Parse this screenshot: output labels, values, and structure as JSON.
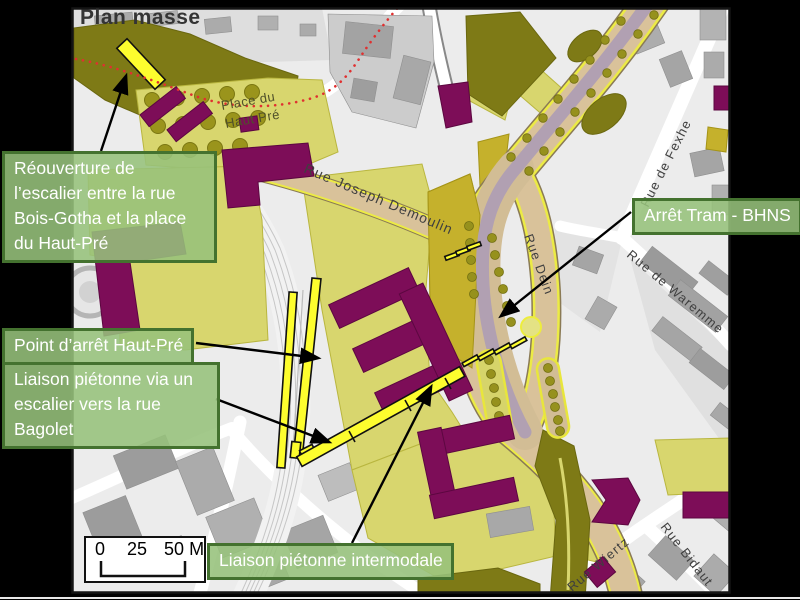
{
  "title": "Plan masse",
  "annotations": {
    "reouverture": "Réouverture de l’escalier entre la rue Bois-Gotha et la place du Haut-Pré",
    "arret_tram": "Arrêt Tram - BHNS",
    "point_arret": "Point d’arrêt Haut-Pré",
    "liaison_escalier": "Liaison piétonne via un escalier vers la rue Bagolet",
    "liaison_intermodale": "Liaison piétonne intermodale"
  },
  "streets": {
    "joseph_demoulin": "Rue Joseph Demoulin",
    "dein": "Rue Dein",
    "fexhe": "Rue de Fexhe",
    "waremme": "Rue de Waremme",
    "wiertz": "Rue Wiertz",
    "bidaut": "Rue Bidaut",
    "place_line1": "Place du",
    "place_line2": "Haut Pré"
  },
  "scale_bar": {
    "ticks": [
      "0",
      "25",
      "50"
    ],
    "unit": "M"
  },
  "legend_colors": {
    "annotation_fill": "#96c27b",
    "annotation_border": "#44722f",
    "project_lime": "#d8d66e",
    "vegetation_olive": "#7e7a16",
    "building_purple": "#7d0d58",
    "road_tan": "#d9c29a",
    "tram_mauve": "#b1a0b2",
    "highlight_yellow": "#fdfd2e",
    "route_red": "#e03030"
  }
}
